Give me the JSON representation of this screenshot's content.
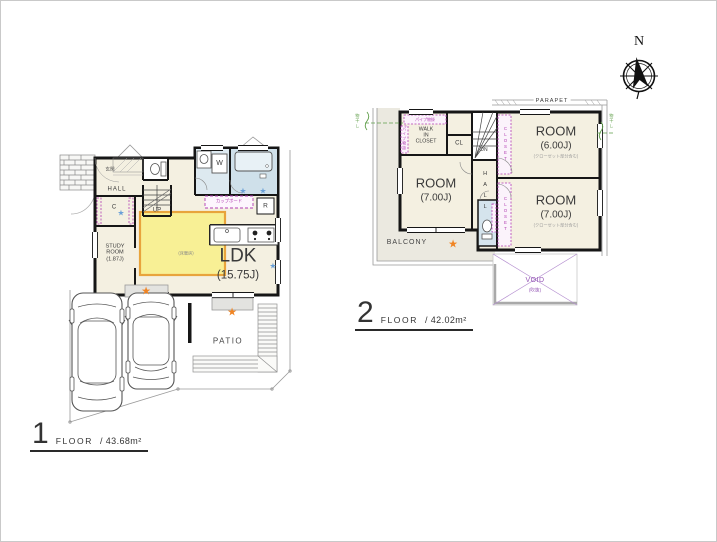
{
  "colors": {
    "wall": "#161616",
    "floor": "#f4f0e1",
    "wet_floor": "#cfe0ea",
    "heating_fill": "#f8f095",
    "heating_border": "#e8a43c",
    "annotation_purple": "#b13db3",
    "annotation_green": "#5f9e49",
    "star_orange": "#f08423",
    "star_blue": "#6aa0d8",
    "boundary_gray": "#9a9a9a",
    "balcony_fill": "#ebe9e0"
  },
  "markers": {
    "star": "★"
  },
  "compass": {
    "north": "N"
  },
  "floor1": {
    "caption": {
      "number": "1",
      "floor_label": "FLOOR",
      "area": "/ 43.68m²"
    },
    "labels": {
      "entrance": "玄関",
      "hall": "HALL",
      "up": "UP",
      "closet": "C",
      "study": [
        "STUDY",
        "ROOM",
        "(1.87J)"
      ],
      "ldk": "LDK",
      "ldk_size": "(15.75J)",
      "floor_heating": "(床暖房)",
      "cupboard": "カップボード",
      "refrigerator": "R",
      "washer": "W",
      "patio": "PATIO"
    }
  },
  "floor2": {
    "caption": {
      "number": "2",
      "floor_label": "FLOOR",
      "area": "/ 42.02m²"
    },
    "labels": {
      "parapet": "PARAPET",
      "wic": [
        "WALK",
        "IN",
        "CLOSET"
      ],
      "pipe_top": "パイプ物掛",
      "pipe_left": "パイプ物掛",
      "cl": "CL",
      "dn": "DN",
      "hall": "HALL",
      "room_left": {
        "name": "ROOM",
        "size": "(7.00J)"
      },
      "room_top_right": {
        "name": "ROOM",
        "size": "(6.00J)",
        "note": "(クローゼット部分含む)"
      },
      "room_bottom_right": {
        "name": "ROOM",
        "size": "(7.00J)",
        "note": "(クローゼット部分含む)"
      },
      "closet_top": "CLOSET",
      "closet_bottom": "CLOSET",
      "balcony": "BALCONY",
      "void": "VOID",
      "void_note": "(吹抜)",
      "laundry_left": "物干し",
      "laundry_right": "物干し"
    }
  }
}
